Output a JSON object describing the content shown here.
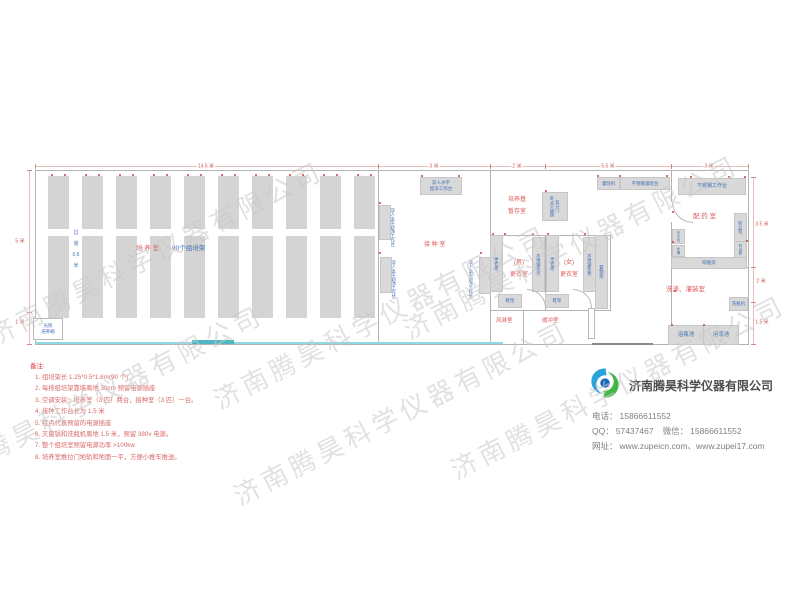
{
  "watermark": {
    "text": "济南腾昊科学仪器有限公司",
    "positions": [
      {
        "x": -10,
        "y": 318
      },
      {
        "x": 215,
        "y": 382
      },
      {
        "x": -70,
        "y": 462
      },
      {
        "x": 235,
        "y": 478
      },
      {
        "x": 405,
        "y": 312
      },
      {
        "x": 452,
        "y": 452
      }
    ]
  },
  "plan": {
    "walls": [
      [
        35,
        170,
        714,
        1
      ],
      [
        35,
        344,
        714,
        1
      ],
      [
        35,
        170,
        1,
        175
      ],
      [
        748,
        170,
        1,
        175
      ],
      [
        378,
        170,
        1,
        175
      ],
      [
        490,
        170,
        1,
        175
      ],
      [
        671,
        170,
        1,
        32
      ],
      [
        671,
        222,
        1,
        123
      ],
      [
        545,
        235,
        1,
        76
      ],
      [
        610,
        235,
        1,
        76
      ],
      [
        490,
        235,
        121,
        1
      ],
      [
        490,
        310,
        121,
        1
      ],
      [
        523,
        310,
        1,
        35
      ],
      [
        671,
        267,
        78,
        1
      ]
    ],
    "racks": {
      "count": 10,
      "x0": 48,
      "pitch": 34,
      "w": 21,
      "segs": [
        [
          176,
          53
        ],
        [
          236,
          82
        ]
      ],
      "dot_y": 174
    },
    "equipment": [
      {
        "n": "clean-bench-top",
        "t": "双人水平\n超净工作台",
        "x": 420,
        "y": 177,
        "w": 40,
        "h": 16,
        "fs": 4.5
      },
      {
        "n": "clean-bench-left-1",
        "t": "",
        "x": 379,
        "y": 205,
        "w": 10,
        "h": 33,
        "fs": 4
      },
      {
        "n": "clean-bench-left-2",
        "t": "",
        "x": 380,
        "y": 257,
        "w": 10,
        "h": 34,
        "fs": 4
      },
      {
        "n": "clean-bench-right",
        "t": "",
        "x": 479,
        "y": 257,
        "w": 10,
        "h": 35,
        "fs": 4
      },
      {
        "n": "wardrobe-male",
        "t": "更衣柜",
        "x": 490,
        "y": 235,
        "w": 11,
        "h": 55,
        "v": 1,
        "fs": 4.5
      },
      {
        "n": "steel-bench-male",
        "t": "不锈钢条凳",
        "x": 532,
        "y": 237,
        "w": 11,
        "h": 53,
        "v": 1,
        "fs": 4.3
      },
      {
        "n": "wardrobe-female",
        "t": "更衣柜",
        "x": 546,
        "y": 235,
        "w": 11,
        "h": 55,
        "v": 1,
        "fs": 4.5
      },
      {
        "n": "steel-bench-female",
        "t": "不锈钢条凳",
        "x": 583,
        "y": 237,
        "w": 11,
        "h": 53,
        "v": 1,
        "fs": 4.3
      },
      {
        "n": "storage-rack",
        "t": "置物架",
        "x": 595,
        "y": 235,
        "w": 11,
        "h": 72,
        "v": 1,
        "fs": 4.5
      },
      {
        "n": "shoe-rack-male",
        "t": "鞋架",
        "x": 498,
        "y": 294,
        "w": 22,
        "h": 12,
        "fs": 4.5
      },
      {
        "n": "shoe-rack-female",
        "t": "鞋架",
        "x": 545,
        "y": 294,
        "w": 22,
        "h": 12,
        "fs": 4.5
      },
      {
        "n": "sterilizer",
        "t": "双开门\n卧式灭菌锅",
        "x": 542,
        "y": 192,
        "w": 24,
        "h": 27,
        "v": 1,
        "fs": 4.2
      },
      {
        "n": "filling-machine",
        "t": "灌装机",
        "x": 597,
        "y": 177,
        "w": 21,
        "h": 11,
        "fs": 4.5
      },
      {
        "n": "steel-filling-table",
        "t": "不锈钢灌装台",
        "x": 620,
        "y": 177,
        "w": 48,
        "h": 11,
        "fs": 4.5
      },
      {
        "n": "steel-worktable",
        "t": "不锈钢工作台",
        "x": 678,
        "y": 178,
        "w": 66,
        "h": 15,
        "fs": 5
      },
      {
        "n": "medicine-cabinet-1",
        "t": "药品柜",
        "x": 734,
        "y": 213,
        "w": 11,
        "h": 27,
        "v": 1,
        "fs": 4.2
      },
      {
        "n": "medicine-cabinet-2",
        "t": "药品柜",
        "x": 734,
        "y": 241,
        "w": 11,
        "h": 15,
        "v": 1,
        "fs": 3.6
      },
      {
        "n": "balance-table",
        "t": "天平台",
        "x": 672,
        "y": 229,
        "w": 11,
        "h": 13,
        "v": 1,
        "fs": 3.6
      },
      {
        "n": "sink",
        "t": "水槽",
        "x": 672,
        "y": 245,
        "w": 11,
        "h": 10,
        "v": 1,
        "fs": 3.6
      },
      {
        "n": "bottle-drying-rack",
        "t": "晾瓶架",
        "x": 671,
        "y": 257,
        "w": 74,
        "h": 10,
        "fs": 4.5
      },
      {
        "n": "bottle-washer",
        "t": "洗瓶机",
        "x": 729,
        "y": 297,
        "w": 17,
        "h": 12,
        "fs": 4.5
      },
      {
        "n": "bottle-soak-pool-1",
        "t": "泡瓶池",
        "x": 668,
        "y": 325,
        "w": 34,
        "h": 18,
        "fs": 5.5
      },
      {
        "n": "bottle-soak-pool-2",
        "t": "泡瓶池",
        "x": 703,
        "y": 325,
        "w": 34,
        "h": 18,
        "fs": 5.5
      },
      {
        "n": "light-incubator",
        "t": "光照\n培养箱",
        "x": 33,
        "y": 318,
        "w": 28,
        "h": 20,
        "fs": 4.5,
        "white": 1
      },
      {
        "n": "door-panel",
        "t": "",
        "x": 588,
        "y": 308,
        "w": 5,
        "h": 29,
        "white": 1
      }
    ],
    "labels": [
      {
        "n": "cultivation-room-label",
        "t": "培 养 室",
        "x": 136,
        "y": 245,
        "fs": 6.5,
        "c": "r"
      },
      {
        "n": "rack-count-label",
        "t": "90个组培架",
        "x": 172,
        "y": 245,
        "fs": 6.5,
        "c": "b"
      },
      {
        "n": "aisle-label",
        "t": "过\n道\n0.6\n米",
        "x": 70,
        "y": 228,
        "fs": 5,
        "c": "b",
        "w": 12,
        "lh": 11
      },
      {
        "n": "inoculation-room-label",
        "t": "接 种 室",
        "x": 424,
        "y": 242,
        "fs": 6,
        "c": "r"
      },
      {
        "n": "medium-storage-label",
        "t": "培养基\n暂存室",
        "x": 504,
        "y": 194,
        "fs": 6,
        "c": "r",
        "w": 26,
        "lh": 12
      },
      {
        "n": "male-changing-label",
        "t": "(男)\n更衣室",
        "x": 506,
        "y": 257,
        "fs": 6,
        "c": "r",
        "w": 26,
        "lh": 12
      },
      {
        "n": "female-changing-label",
        "t": "(女)\n更衣室",
        "x": 556,
        "y": 257,
        "fs": 6,
        "c": "r",
        "w": 26,
        "lh": 12
      },
      {
        "n": "air-shower-label",
        "t": "风淋室",
        "x": 496,
        "y": 318,
        "fs": 5.5,
        "c": "r"
      },
      {
        "n": "buffer-room-label",
        "t": "缓冲室",
        "x": 542,
        "y": 318,
        "fs": 5.5,
        "c": "r"
      },
      {
        "n": "dispensary-label",
        "t": "配 药 室",
        "x": 693,
        "y": 213,
        "fs": 6.5,
        "c": "r"
      },
      {
        "n": "washing-filling-room-label",
        "t": "洗涤、灌装室",
        "x": 666,
        "y": 286,
        "fs": 6.5,
        "c": "r"
      },
      {
        "n": "bench-text-left-1",
        "t": "双人水平超净工作台",
        "x": 390,
        "y": 204,
        "fs": 4.3,
        "c": "b",
        "v": 1,
        "h": 46
      },
      {
        "n": "bench-text-left-2",
        "t": "双人水平超净工作台",
        "x": 391,
        "y": 256,
        "fs": 4.3,
        "c": "b",
        "v": 1,
        "h": 46
      },
      {
        "n": "bench-text-right",
        "t": "双人水平超净工作台",
        "x": 468,
        "y": 256,
        "fs": 4.3,
        "c": "b",
        "v": 1,
        "h": 46
      }
    ],
    "dots": [
      [
        379,
        202
      ],
      [
        379,
        252
      ],
      [
        480,
        252
      ],
      [
        421,
        175
      ],
      [
        458,
        175
      ],
      [
        492,
        233
      ],
      [
        532,
        233
      ],
      [
        547,
        233
      ],
      [
        584,
        233
      ],
      [
        504,
        233
      ],
      [
        545,
        190
      ],
      [
        597,
        175
      ],
      [
        619,
        175
      ],
      [
        666,
        175
      ],
      [
        690,
        176
      ],
      [
        728,
        176
      ],
      [
        744,
        176
      ],
      [
        672,
        211
      ],
      [
        672,
        241
      ],
      [
        674,
        290
      ],
      [
        746,
        240
      ],
      [
        671,
        324
      ],
      [
        703,
        324
      ]
    ],
    "arcs": [
      {
        "x": 527,
        "y": 289,
        "s": 18,
        "k": "tr"
      },
      {
        "x": 573,
        "y": 289,
        "s": 18,
        "k": "tr"
      },
      {
        "x": 672,
        "y": 202,
        "s": 20,
        "k": "bl"
      }
    ],
    "lines": [
      {
        "x": 35,
        "y": 342,
        "w": 468,
        "h": 2,
        "c": "#8fd9e6"
      },
      {
        "x": 192,
        "y": 340,
        "w": 42,
        "h": 4,
        "c": "#4fb6c4"
      },
      {
        "x": 592,
        "y": 343,
        "w": 61,
        "h": 2,
        "c": "#8a8a8a"
      }
    ],
    "dims": {
      "lines": [
        [
          35,
          166,
          713,
          1
        ],
        [
          29,
          170,
          1,
          174
        ],
        [
          753,
          177,
          1,
          167
        ]
      ],
      "ticks_top": [
        35,
        378,
        490,
        545,
        671,
        748
      ],
      "ticks_left": [
        170,
        312,
        344
      ],
      "ticks_right": [
        177,
        267,
        302,
        344
      ],
      "labels": [
        {
          "t": "14.5 米",
          "x": 206,
          "y": 166
        },
        {
          "t": "3 米",
          "x": 434,
          "y": 166
        },
        {
          "t": "2 米",
          "x": 517,
          "y": 166
        },
        {
          "t": "5.5 米",
          "x": 608,
          "y": 166
        },
        {
          "t": "3 米",
          "x": 709,
          "y": 166
        },
        {
          "t": "5 米",
          "x": 20,
          "y": 241
        },
        {
          "t": "1 米",
          "x": 20,
          "y": 322
        },
        {
          "t": "3.5 米",
          "x": 762,
          "y": 224
        },
        {
          "t": "2 米",
          "x": 761,
          "y": 281
        },
        {
          "t": "1.5 米",
          "x": 762,
          "y": 322
        }
      ]
    }
  },
  "notes": {
    "title": "备注:",
    "items": [
      "组培架长 1.25*0.5*1.8m(90 个)",
      "每排组培架靠墙离地 30cm 预留电源插座",
      "空调安装：培养室（3 匹）两台，接种室（3 匹）一台。",
      "接种工作台长为 1.5 米",
      "红点代表预留的电源插座",
      "灭菌锅和洗瓶机离地 1.5 米，预留 380v 电源。",
      "整个组培室预留电源功率 >100kw",
      "培养室推拉门地轨和地面一平，方便小推车推送。"
    ]
  },
  "company": {
    "name": "济南腾昊科学仪器有限公司",
    "phone_label": "电话：",
    "phone": "15866611552",
    "qq_label": "QQ：",
    "qq": "57437467",
    "wechat_label": "微信：",
    "wechat": "15866611552",
    "website_label": "网址：",
    "websites": "www.zupeicn.com、www.zupei17.com"
  }
}
